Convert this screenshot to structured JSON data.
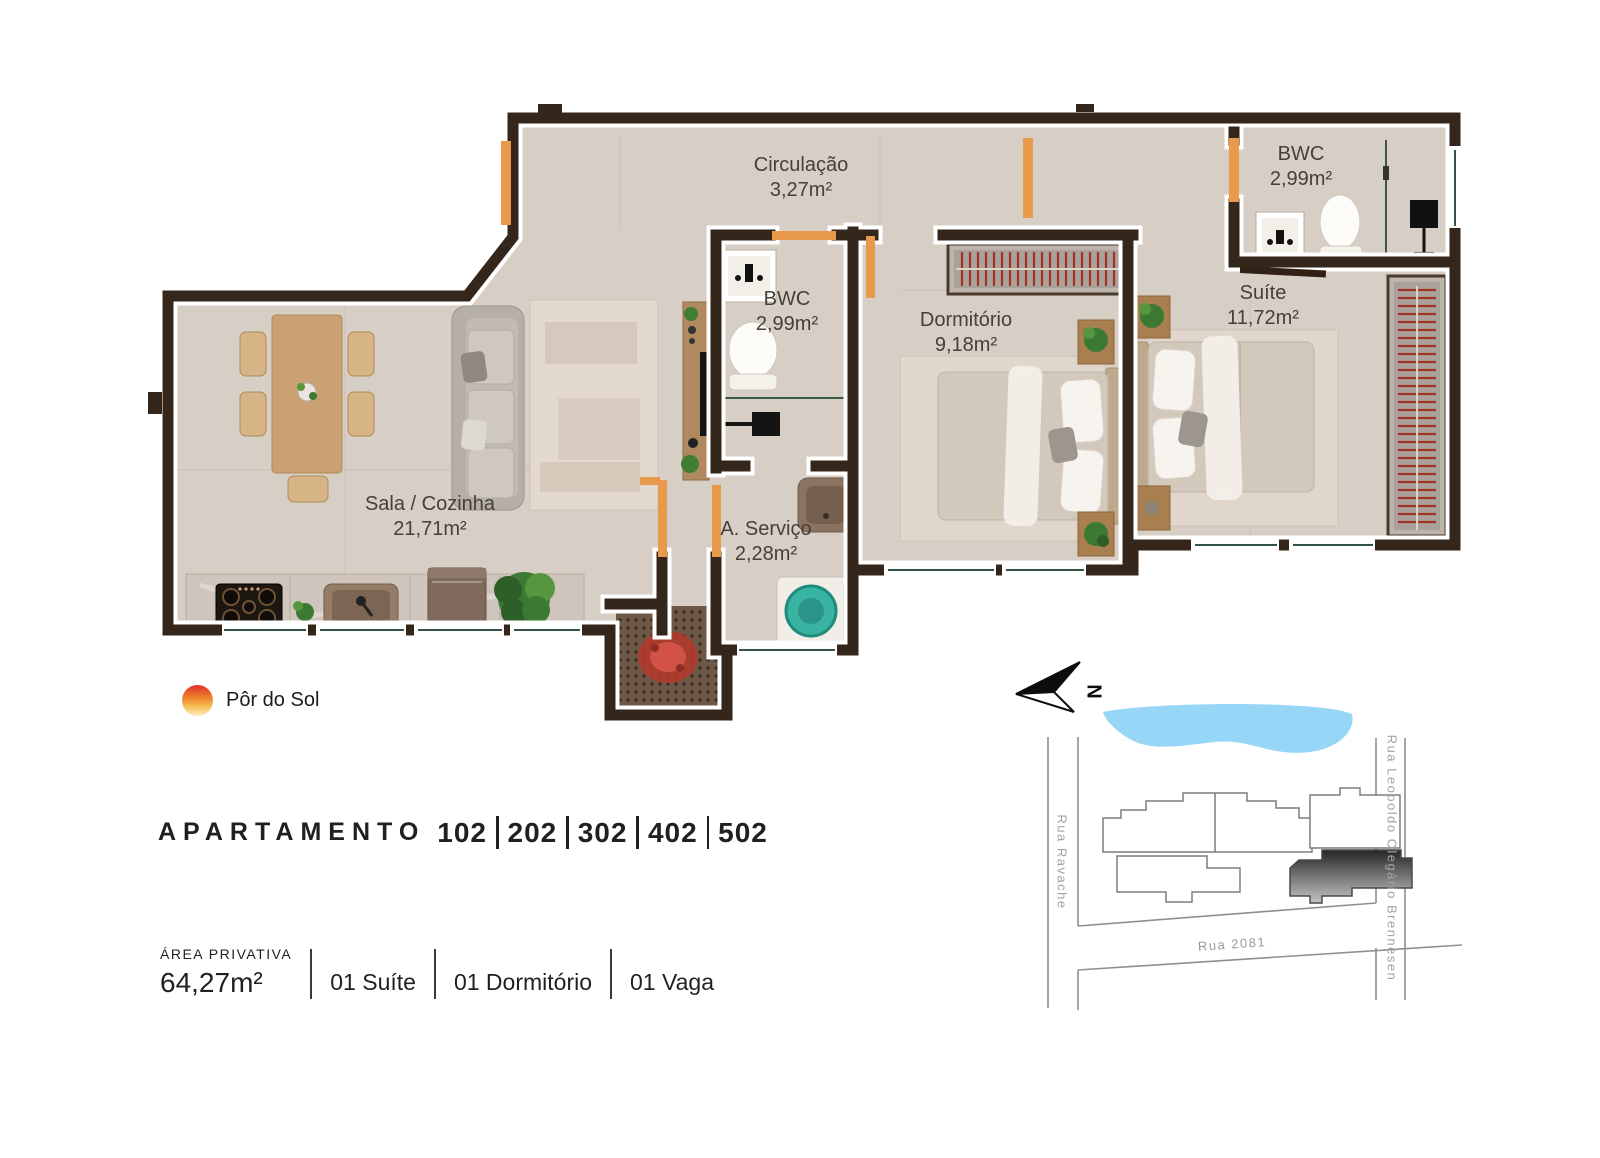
{
  "floor_plan": {
    "rooms": [
      {
        "id": "circulacao",
        "name": "Circulação",
        "area": "3,27m²"
      },
      {
        "id": "bwc-suite",
        "name": "BWC",
        "area": "2,99m²"
      },
      {
        "id": "suite",
        "name": "Suíte",
        "area": "11,72m²"
      },
      {
        "id": "bwc",
        "name": "BWC",
        "area": "2,99m²"
      },
      {
        "id": "dormitorio",
        "name": "Dormitório",
        "area": "9,18m²"
      },
      {
        "id": "sala-cozinha",
        "name": "Sala / Cozinha",
        "area": "21,71m²"
      },
      {
        "id": "a-servico",
        "name": "A. Serviço",
        "area": "2,28m²"
      }
    ],
    "legend": {
      "sunset_label": "Pôr do Sol"
    }
  },
  "apartment": {
    "title": "APARTAMENTO",
    "units": [
      "102",
      "202",
      "302",
      "402",
      "502"
    ]
  },
  "details": {
    "private_area_label": "ÁREA PRIVATIVA",
    "private_area_value": "64,27m²",
    "features": [
      "01 Suíte",
      "01 Dormitório",
      "01 Vaga"
    ]
  },
  "site_map": {
    "north_label": "N",
    "streets": {
      "left": "Rua Ravache",
      "right": "Rua Leopoldo Olegário Brennesen",
      "bottom": "Rua 2081"
    }
  },
  "colors": {
    "wall": "#34261a",
    "floor": "#d7cec6",
    "accent_door": "#e89a4a",
    "hanger_red": "#a33327",
    "washer_teal": "#39b3a2",
    "water_blue": "#98d6f7",
    "text_dark": "#231f20",
    "street_gray": "#a3a3a3",
    "sun_top": "#e23a2b",
    "sun_bottom": "#fbe9b0",
    "highlight_unit_dark": "#2b2b2b"
  }
}
